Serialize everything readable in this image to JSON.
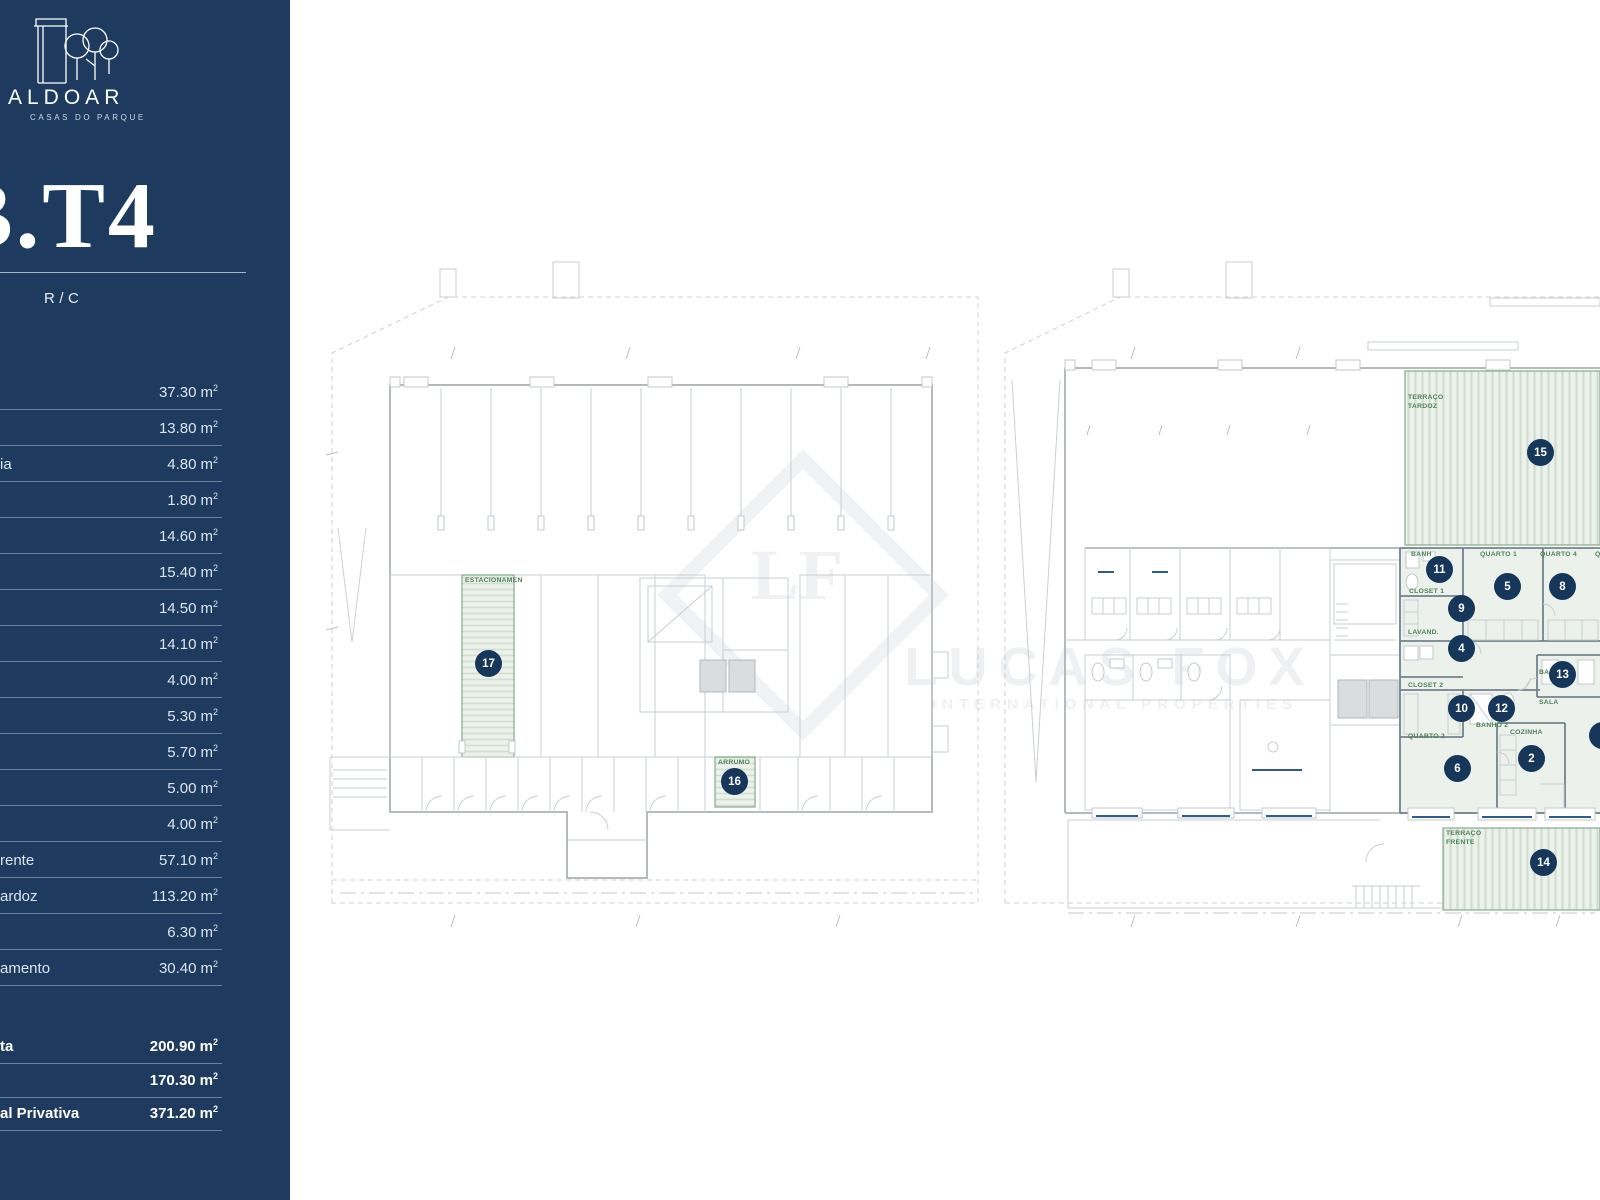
{
  "brand": {
    "wordmark": "ALDOAR",
    "tagline": "CASAS DO PARQUE"
  },
  "unit": {
    "code": "B.T4",
    "floor": "R/C"
  },
  "areas": {
    "unit": "m",
    "sup": "2",
    "rows": [
      {
        "label": "",
        "value": "37.30"
      },
      {
        "label": "",
        "value": "13.80"
      },
      {
        "label": "ia",
        "value": "4.80"
      },
      {
        "label": "",
        "value": "1.80"
      },
      {
        "label": "",
        "value": "14.60"
      },
      {
        "label": "",
        "value": "15.40"
      },
      {
        "label": "",
        "value": "14.50"
      },
      {
        "label": "",
        "value": "14.10"
      },
      {
        "label": "",
        "value": "4.00"
      },
      {
        "label": "",
        "value": "5.30"
      },
      {
        "label": "",
        "value": "5.70"
      },
      {
        "label": "",
        "value": "5.00"
      },
      {
        "label": "",
        "value": "4.00"
      },
      {
        "label": "rente",
        "value": "57.10"
      },
      {
        "label": "ardoz",
        "value": "113.20"
      },
      {
        "label": "",
        "value": "6.30"
      },
      {
        "label": "amento",
        "value": "30.40"
      }
    ]
  },
  "totals": {
    "rows": [
      {
        "label": "ta",
        "value": "200.90"
      },
      {
        "label": "",
        "value": "170.30"
      },
      {
        "label": "al Privativa",
        "value": "371.20"
      }
    ]
  },
  "plan_labels": {
    "estacionamento": "ESTACIONAMEN",
    "arrumo": "ARRUMO",
    "terraco": "TERRAÇO",
    "tardoz": "TARDOZ",
    "frente": "FRENTE",
    "banho1": "BANH",
    "quarto1": "QUARTO 1",
    "quarto4": "QUARTO 4",
    "quarto_cut": "Q",
    "closet1": "CLOSET 1",
    "lavandaria": "LAVAND.",
    "closet2": "CLOSET 2",
    "banho2": "BANHO 2",
    "quarto2": "QUARTO 2",
    "cozinha": "COZINHA",
    "banho3": "BA",
    "sala": "SALA"
  },
  "badges": {
    "b1": "1",
    "b2": "2",
    "b4": "4",
    "b5": "5",
    "b6": "6",
    "b8": "8",
    "b9": "9",
    "b10": "10",
    "b11": "11",
    "b12": "12",
    "b13": "13",
    "b14": "14",
    "b15": "15",
    "b16": "16",
    "b17": "17"
  },
  "watermark": {
    "monogram": "LF",
    "title": "LUCAS FOX",
    "subtitle": "INTERNATIONAL PROPERTIES"
  },
  "colors": {
    "sidebar": "#1e3a5e",
    "badge": "#16365a",
    "highlight": "#ecf1ec",
    "highlight_border": "#8fae95",
    "label_green": "#4d8157",
    "window_blue": "#2f5c8d"
  }
}
